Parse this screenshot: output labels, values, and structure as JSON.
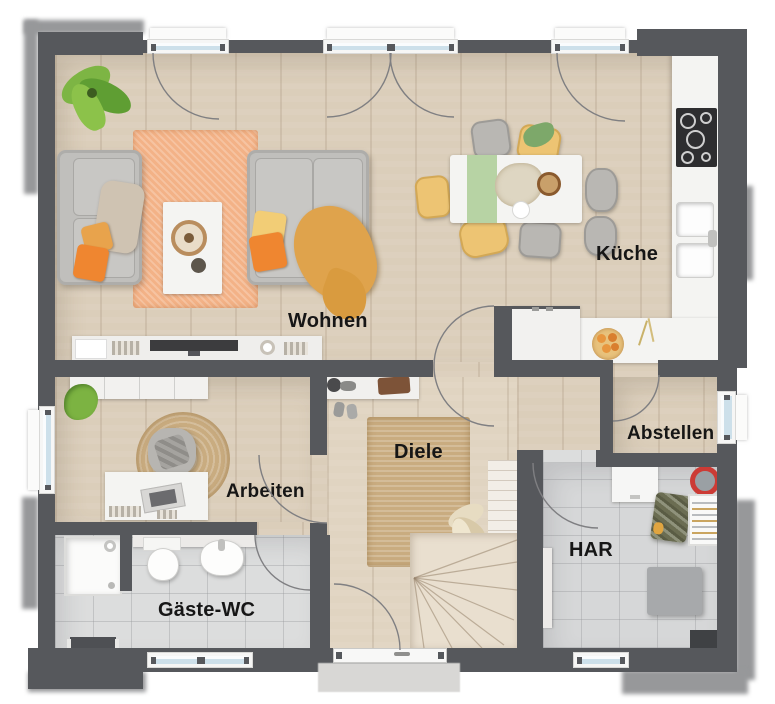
{
  "rooms": {
    "wohnen": {
      "label": "Wohnen"
    },
    "kueche": {
      "label": "Küche"
    },
    "diele": {
      "label": "Diele"
    },
    "arbeiten": {
      "label": "Arbeiten"
    },
    "abstellen": {
      "label": "Abstellen"
    },
    "har": {
      "label": "HAR"
    },
    "elt": {
      "label": "ELT"
    },
    "gaeste_wc": {
      "label": "Gäste-WC"
    }
  },
  "colors": {
    "wall": "#56585c",
    "shadow": "#97989a",
    "wood": "#dbceba",
    "tile": "#dcdddd",
    "rug-orange": "#f3b287",
    "jute": "#c9ac80",
    "glass": "#cde0ea",
    "white-f": "#f4f4f2",
    "stair": "#e9dfcf",
    "label": "#161616"
  }
}
